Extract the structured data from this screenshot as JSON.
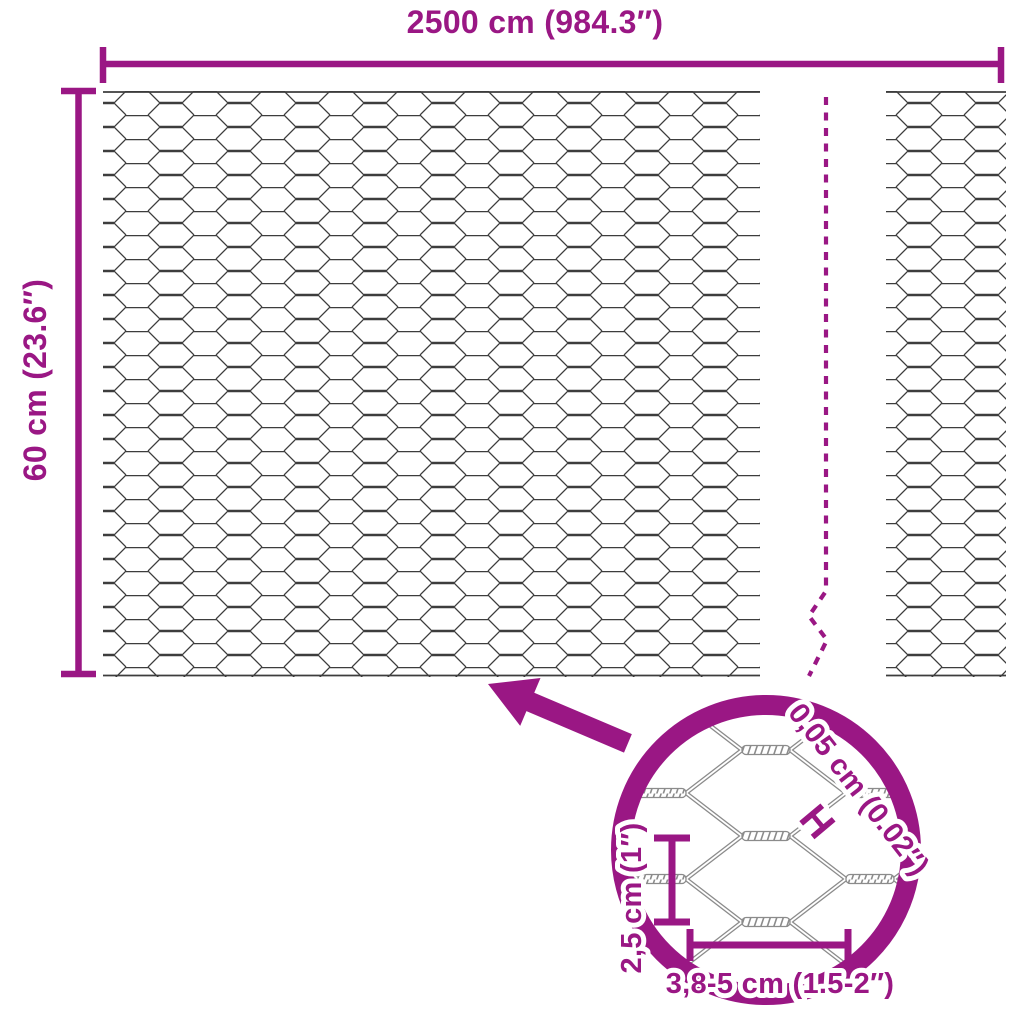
{
  "diagram_title": "chicken-wire-mesh-dimension-diagram",
  "colors": {
    "accent": "#9A1784",
    "wire": "#3D3D3D",
    "wire_detail": "#8B8B8B",
    "background": "#FFFFFF"
  },
  "overall_dimensions": {
    "width_label": "2500 cm (984.3″)",
    "height_label": "60 cm (23.6″)"
  },
  "detail_dimensions": {
    "wire_thickness_label": "0,05 cm (0.02″)",
    "wire_thickness_marker": "H",
    "mesh_height_label": "2,5 cm (1″)",
    "mesh_width_label": "3,8-5 cm (1.5-2″)"
  }
}
